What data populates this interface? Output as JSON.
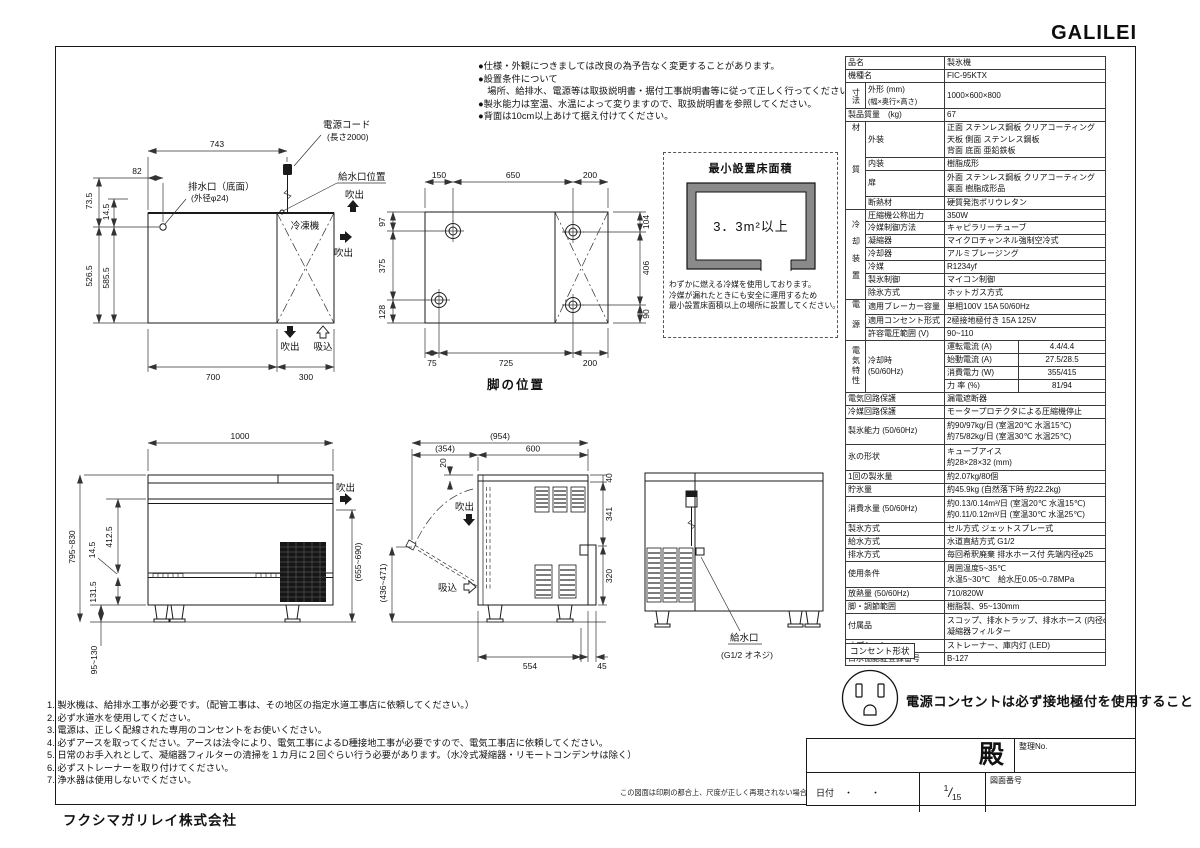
{
  "logo": "GALILEI",
  "company": "フクシマガリレイ株式会社",
  "top_notes": [
    "●仕様・外観につきましては改良の為予告なく変更することがあります。",
    "●設置条件について",
    "　場所、給排水、電源等は取扱説明書・据付工事説明書等に従って正しく行ってください。",
    "●製氷能力は室温、水温によって変りますので、取扱説明書を参照してください。",
    "●背面は10cm以上あけて据え付けてください。"
  ],
  "bottom_notes": [
    "1. 製氷機は、給排水工事が必要です。（配管工事は、その地区の指定水道工事店に依頼してください。）",
    "2. 必ず水道水を使用してください。",
    "3. 電源は、正しく配線された専用のコンセントをお使いください。",
    "4. 必ずアースを取ってください。アースは法令により、電気工事によるD種接地工事が必要ですので、電気工事店に依頼してください。",
    "5. 日常のお手入れとして、凝縮器フィルターの清掃を１カ月に２回ぐらい行う必要があります。（水冷式凝縮器・リモートコンデンサは除く）",
    "6. 必ずストレーナーを取り付けてください。",
    "7. 浄水器は使用しないでください。"
  ],
  "print_note": "この図面は印刷の都合上、尺度が正しく再現されない場合があります。",
  "outlet": {
    "label": "コンセント形状",
    "warning": "電源コンセントは必ず接地極付を使用すること"
  },
  "title_block": {
    "addressee": "殿",
    "ref_no_label": "整理No.",
    "date_label": "日付",
    "date_dots": "・　　・",
    "scale_num": "1",
    "scale_den": "15",
    "drawing_no_label": "図面番号"
  },
  "spec": {
    "product": {
      "label": "品名",
      "value": "製氷機"
    },
    "model": {
      "label": "機種名",
      "value": "FIC-95KTX"
    },
    "size": {
      "group": "寸法",
      "label_1": "外形 (mm)",
      "label_2": "(幅×奥行×高さ)",
      "value": "1000×600×800"
    },
    "weight": {
      "label": "製品質量　(kg)",
      "value": "67"
    },
    "material": {
      "group": "材質",
      "exterior_label": "外装",
      "exterior_lines": [
        "正面 ステンレス鋼板 クリアコーティング",
        "天板 側面 ステンレス鋼板",
        "背面 底面 亜鉛鉄板"
      ],
      "interior_label": "内装",
      "interior": "樹脂成形",
      "door_label": "扉",
      "door_lines": [
        "外面 ステンレス鋼板 クリアコーティング",
        "裏面 樹脂成形品"
      ],
      "insulation_label": "断熱材",
      "insulation": "硬質発泡ポリウレタン"
    },
    "cooling": {
      "group": "冷却装置",
      "rows": [
        {
          "label": "圧縮機公称出力",
          "value": "350W"
        },
        {
          "label": "冷媒制御方法",
          "value": "キャピラリーチューブ"
        },
        {
          "label": "凝縮器",
          "value": "マイクロチャンネル強制空冷式"
        },
        {
          "label": "冷却器",
          "value": "アルミブレージング"
        },
        {
          "label": "冷媒",
          "value": "R1234yf"
        },
        {
          "label": "製氷制御",
          "value": "マイコン制御"
        },
        {
          "label": "除氷方式",
          "value": "ホットガス方式"
        }
      ]
    },
    "power": {
      "group": "電源",
      "rows": [
        {
          "label": "適用ブレーカー容量",
          "value": "単相100V 15A 50/60Hz"
        },
        {
          "label": "適用コンセント形式",
          "value": "2極接地極付き 15A 125V"
        },
        {
          "label": "許容電圧範囲 (V)",
          "value": "90~110"
        }
      ]
    },
    "electrical": {
      "group": "電気特性",
      "condition_1": "冷却時",
      "condition_2": "(50/60Hz)",
      "rows": [
        {
          "label": "運転電流 (A)",
          "value": "4.4/4.4"
        },
        {
          "label": "始動電流 (A)",
          "value": "27.5/28.5"
        },
        {
          "label": "消費電力 (W)",
          "value": "355/415"
        },
        {
          "label": "力 率 (%)",
          "value": "81/94"
        }
      ]
    },
    "protect_circuit": {
      "label": "電気回路保護",
      "value": "漏電遮断器"
    },
    "protect_refrigerant": {
      "label": "冷媒回路保護",
      "value": "モータープロテクタによる圧縮機停止"
    },
    "capacity": {
      "label": "製氷能力 (50/60Hz)",
      "lines": [
        "約90/97kg/日 (室温20℃ 水温15℃)",
        "約75/82kg/日 (室温30℃ 水温25℃)"
      ]
    },
    "ice_shape": {
      "label": "氷の形状",
      "lines": [
        "キューブアイス",
        "約28×28×32 (mm)"
      ]
    },
    "per_batch": {
      "label": "1回の製氷量",
      "value": "約2.07kg/80個"
    },
    "storage": {
      "label": "貯氷量",
      "value": "約45.9kg (自然落下時 約22.2kg)"
    },
    "water_consumption": {
      "label": "消費水量 (50/60Hz)",
      "lines": [
        "約0.13/0.14m³/日 (室温20℃ 水温15℃)",
        "約0.11/0.12m³/日 (室温30℃ 水温25℃)"
      ]
    },
    "ice_method": {
      "label": "製氷方式",
      "value": "セル方式 ジェットスプレー式"
    },
    "supply_method": {
      "label": "給水方式",
      "value": "水道直結方式 G1/2"
    },
    "drain_method": {
      "label": "排水方式",
      "value": "毎回希釈廃棄 排水ホース付 先端内径φ25"
    },
    "conditions": {
      "label": "使用条件",
      "lines": [
        "周囲温度5~35℃",
        "水温5~30℃　給水圧0.05~0.78MPa"
      ]
    },
    "heat": {
      "label": "放熱量 (50/60Hz)",
      "value": "710/820W"
    },
    "legs": {
      "label": "脚・調節範囲",
      "value": "樹脂製、95~130mm"
    },
    "accessories": {
      "label": "付属品",
      "lines": [
        "スコップ、排水トラップ、排水ホース (内径φ25)",
        "凝縮器フィルター"
      ]
    },
    "options": {
      "label": "オプション",
      "value": "ストレーナー、庫内灯 (LED)"
    },
    "certification": {
      "label": "日水協認証登録番号",
      "value": "B-127"
    }
  },
  "drawings": {
    "top_view": {
      "dim_743": "743",
      "dim_82": "82",
      "dim_73_5": "73.5",
      "dim_14_5": "14.5",
      "dim_526_5": "526.5",
      "dim_585_5": "585.5",
      "dim_700": "700",
      "dim_300": "300",
      "label_drain_1": "排水口（底面）",
      "label_drain_2": "(外径φ24)",
      "label_cord_1": "電源コード",
      "label_cord_2": "(長さ2000)",
      "label_inlet": "給水口位置",
      "label_freezer": "冷凍機",
      "label_blow": "吹出",
      "label_suck": "吸込"
    },
    "leg_view": {
      "title": "脚の位置",
      "dim_150": "150",
      "dim_650": "650",
      "dim_200t": "200",
      "dim_104": "104",
      "dim_406": "406",
      "dim_90": "90",
      "dim_97": "97",
      "dim_375": "375",
      "dim_128": "128",
      "dim_75": "75",
      "dim_725": "725",
      "dim_200b": "200"
    },
    "min_area": {
      "title": "最小設置床面積",
      "value": "3．3m²以上",
      "note_lines": [
        "わずかに燃える冷媒を使用しております。",
        "冷媒が漏れたときにも安全に運用するため",
        "最小設置床面積以上の場所に設置してください。"
      ]
    },
    "front_view": {
      "dim_1000": "1000",
      "dim_height": "795~830",
      "dim_14_5": "14.5",
      "dim_412_5": "412.5",
      "dim_131_5": "131.5",
      "dim_leg": "95~130",
      "dim_right": "(655~690)",
      "label_blow": "吹出"
    },
    "side_view": {
      "dim_954": "(954)",
      "dim_354": "(354)",
      "dim_600": "600",
      "dim_20": "20",
      "dim_40": "40",
      "dim_341": "341",
      "dim_320": "320",
      "dim_door": "(436~471)",
      "dim_554": "554",
      "dim_45": "45",
      "label_blow": "吹出",
      "label_suck": "吸込"
    },
    "rear_view": {
      "label_inlet_1": "給水口",
      "label_inlet_2": "(G1/2 オネジ)"
    }
  }
}
